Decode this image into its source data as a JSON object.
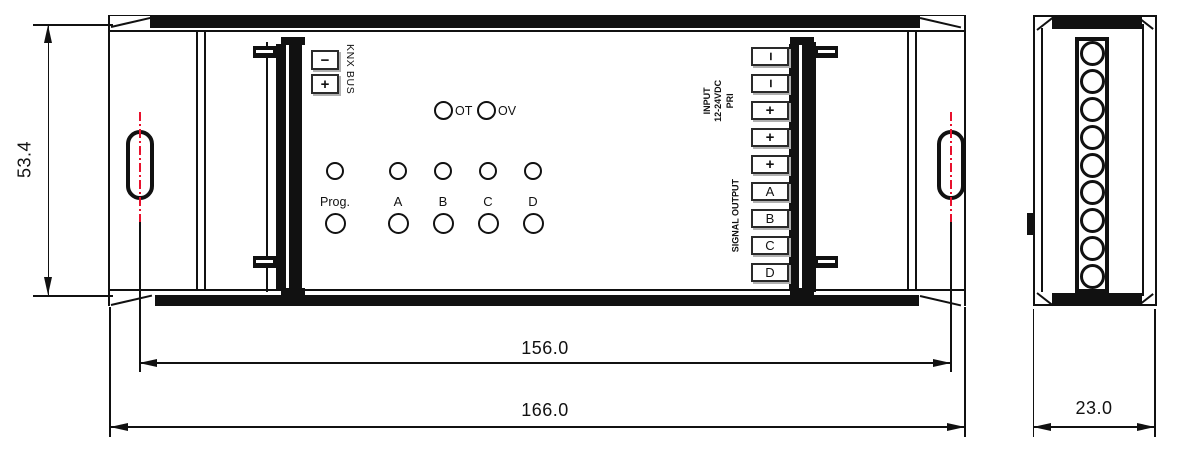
{
  "front": {
    "knx": {
      "label": "KNX BUS",
      "minus": "−",
      "plus": "+"
    },
    "status": {
      "ot": "OT",
      "ov": "OV"
    },
    "channels": [
      "Prog.",
      "A",
      "B",
      "C",
      "D"
    ],
    "input_label": [
      "INPUT",
      "12-24VDC",
      "PRI"
    ],
    "output_label": "SIGNAL OUTPUT",
    "terminals": [
      "−",
      "−",
      "+",
      "+",
      "+",
      "A",
      "B",
      "C",
      "D"
    ]
  },
  "dims": {
    "height": "53.4",
    "mount": "156.0",
    "width": "166.0",
    "depth": "23.0"
  },
  "colors": {
    "line": "#111111",
    "centerline": "#e8112d",
    "background": "#ffffff"
  }
}
